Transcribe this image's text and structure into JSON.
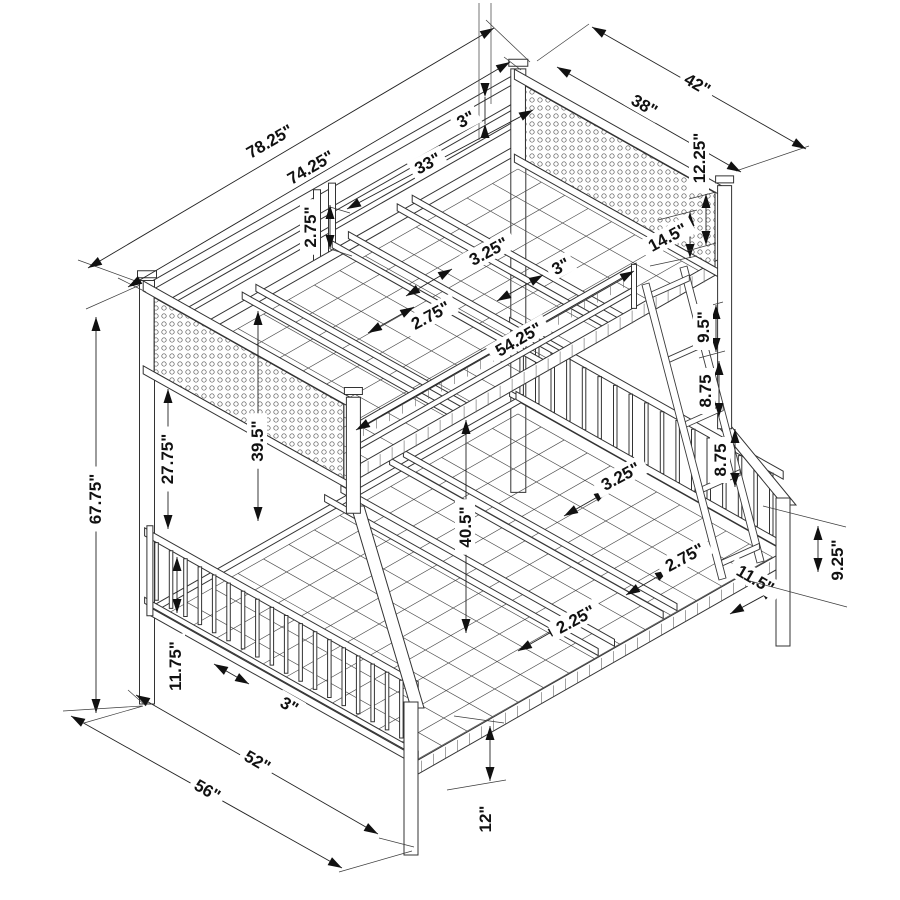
{
  "canvas": {
    "width": 900,
    "height": 900,
    "background": "#ffffff",
    "line_color": "#333333",
    "accent_color": "#111111"
  },
  "diagram": {
    "type": "isometric-dimension-drawing",
    "subject": "twin-over-full-bunk-bed",
    "units": "inches"
  },
  "dims": [
    {
      "label": "78.25\"",
      "x": 270,
      "y": 142,
      "rot": -30,
      "line": [
        88,
        268,
        494,
        28
      ],
      "arrows": "out",
      "ext": [
        [
          141,
          283,
          78,
          260
        ],
        [
          530,
          62,
          486,
          20
        ]
      ]
    },
    {
      "label": "74.25\"",
      "x": 311,
      "y": 168,
      "rot": -30,
      "line": [
        128,
        287,
        510,
        62
      ],
      "arrows": "out",
      "ext": [
        [
          146,
          292,
          118,
          278
        ],
        [
          521,
          70,
          504,
          57
        ]
      ]
    },
    {
      "label": "33\"",
      "x": 428,
      "y": 164,
      "rot": -28,
      "line": [
        347,
        209,
        533,
        110
      ],
      "arrows": "out",
      "ext": []
    },
    {
      "label": "3\"",
      "x": 466,
      "y": 120,
      "rot": -28,
      "line": [
        485,
        97,
        485,
        124
      ],
      "arrows": "in",
      "ext": [
        [
          479,
          3,
          479,
          140
        ],
        [
          491,
          3,
          491,
          104
        ]
      ]
    },
    {
      "label": "2.75\"",
      "x": 311,
      "y": 227,
      "rot": -90,
      "line": [
        330,
        205,
        330,
        249
      ],
      "arrows": "out",
      "ext": [
        [
          330,
          207,
          350,
          213
        ],
        [
          330,
          249,
          352,
          256
        ]
      ]
    },
    {
      "label": "3.25\"",
      "x": 489,
      "y": 252,
      "rot": -28,
      "line": [
        406,
        296,
        452,
        269
      ],
      "arrows": "out",
      "ext": []
    },
    {
      "label": "3\"",
      "x": 561,
      "y": 267,
      "rot": -28,
      "line": [
        497,
        301,
        543,
        275
      ],
      "arrows": "out",
      "ext": []
    },
    {
      "label": "2.75\"",
      "x": 431,
      "y": 316,
      "rot": -28,
      "line": [
        368,
        333,
        414,
        307
      ],
      "arrows": "out",
      "ext": []
    },
    {
      "label": "54.25\"",
      "x": 519,
      "y": 340,
      "rot": -30,
      "line": [
        356,
        430,
        634,
        271
      ],
      "arrows": "out",
      "ext": []
    },
    {
      "label": "14.5\"",
      "x": 668,
      "y": 238,
      "rot": -28,
      "line": [
        690,
        212,
        690,
        258
      ],
      "arrows": "out",
      "ext": [
        [
          658,
          220,
          697,
          210
        ],
        [
          650,
          266,
          697,
          256
        ]
      ]
    },
    {
      "label": "42\"",
      "x": 697,
      "y": 85,
      "rot": 30,
      "line": [
        592,
        27,
        806,
        149
      ],
      "arrows": "out",
      "ext": [
        [
          537,
          61,
          589,
          24
        ],
        [
          736,
          171,
          809,
          146
        ]
      ]
    },
    {
      "label": "38\"",
      "x": 644,
      "y": 106,
      "rot": 30,
      "line": [
        557,
        67,
        741,
        172
      ],
      "arrows": "out",
      "ext": []
    },
    {
      "label": "12.25\"",
      "x": 700,
      "y": 158,
      "rot": -90,
      "line": [
        706,
        194,
        706,
        245
      ],
      "arrows": "out",
      "ext": [
        [
          689,
          199,
          716,
          192
        ],
        [
          687,
          251,
          716,
          243
        ]
      ]
    },
    {
      "label": "9.5\"",
      "x": 704,
      "y": 327,
      "rot": -90,
      "line": [
        716,
        305,
        716,
        352
      ],
      "arrows": "out",
      "ext": [
        [
          698,
          309,
          723,
          302
        ],
        [
          699,
          358,
          725,
          351
        ]
      ]
    },
    {
      "label": "8.75",
      "x": 706,
      "y": 391,
      "rot": -90,
      "line": [
        719,
        361,
        719,
        417
      ],
      "arrows": "out",
      "ext": []
    },
    {
      "label": "8.75",
      "x": 721,
      "y": 460,
      "rot": -90,
      "line": [
        735,
        429,
        735,
        487
      ],
      "arrows": "out",
      "ext": []
    },
    {
      "label": "3.25\"",
      "x": 621,
      "y": 477,
      "rot": -28,
      "line": [
        564,
        516,
        608,
        491
      ],
      "arrows": "out",
      "ext": []
    },
    {
      "label": "2.75\"",
      "x": 685,
      "y": 558,
      "rot": -28,
      "line": [
        626,
        595,
        669,
        570
      ],
      "arrows": "out",
      "ext": []
    },
    {
      "label": "2.25\"",
      "x": 576,
      "y": 620,
      "rot": -28,
      "line": [
        518,
        651,
        562,
        626
      ],
      "arrows": "out",
      "ext": []
    },
    {
      "label": "40.5\"",
      "x": 466,
      "y": 527,
      "rot": -90,
      "line": [
        466,
        420,
        466,
        633
      ],
      "arrows": "out",
      "ext": []
    },
    {
      "label": "39.5\"",
      "x": 258,
      "y": 441,
      "rot": -90,
      "line": [
        258,
        311,
        258,
        521
      ],
      "arrows": "out",
      "ext": []
    },
    {
      "label": "27.75\"",
      "x": 168,
      "y": 459,
      "rot": -90,
      "line": [
        168,
        389,
        168,
        529
      ],
      "arrows": "out",
      "ext": []
    },
    {
      "label": "67.75\"",
      "x": 96,
      "y": 499,
      "rot": -90,
      "line": [
        96,
        317,
        96,
        713
      ],
      "arrows": "out",
      "ext": [
        [
          140,
          285,
          86,
          309
        ],
        [
          143,
          706,
          84,
          723
        ]
      ]
    },
    {
      "label": "11.75\"",
      "x": 176,
      "y": 666,
      "rot": -90,
      "line": [
        177,
        557,
        177,
        613
      ],
      "arrows": "out",
      "ext": []
    },
    {
      "label": "3\"",
      "x": 289,
      "y": 706,
      "rot": 30,
      "line": [
        214,
        664,
        249,
        684
      ],
      "arrows": "out",
      "ext": []
    },
    {
      "label": "52\"",
      "x": 257,
      "y": 762,
      "rot": 30,
      "line": [
        136,
        695,
        378,
        834
      ],
      "arrows": "out",
      "ext": [
        [
          146,
          706,
          128,
          690
        ],
        [
          414,
          847,
          379,
          838
        ]
      ]
    },
    {
      "label": "56\"",
      "x": 207,
      "y": 791,
      "rot": 30,
      "line": [
        71,
        716,
        342,
        868
      ],
      "arrows": "out",
      "ext": [
        [
          142,
          706,
          63,
          711
        ],
        [
          412,
          851,
          339,
          872
        ]
      ]
    },
    {
      "label": "12\"",
      "x": 486,
      "y": 819,
      "rot": -90,
      "line": [
        490,
        726,
        490,
        781
      ],
      "arrows": "out",
      "ext": [
        [
          454,
          716,
          504,
          723
        ],
        [
          447,
          790,
          506,
          780
        ]
      ]
    },
    {
      "label": "11.5\"",
      "x": 755,
      "y": 580,
      "rot": 30,
      "line": [
        730,
        614,
        776,
        589
      ],
      "arrows": "out",
      "ext": []
    },
    {
      "label": "9.25\"",
      "x": 838,
      "y": 560,
      "rot": -90,
      "line": [
        818,
        526,
        818,
        572
      ],
      "arrows": "out",
      "ext": [
        [
          763,
          506,
          846,
          527
        ],
        [
          750,
          581,
          847,
          607
        ]
      ]
    }
  ]
}
